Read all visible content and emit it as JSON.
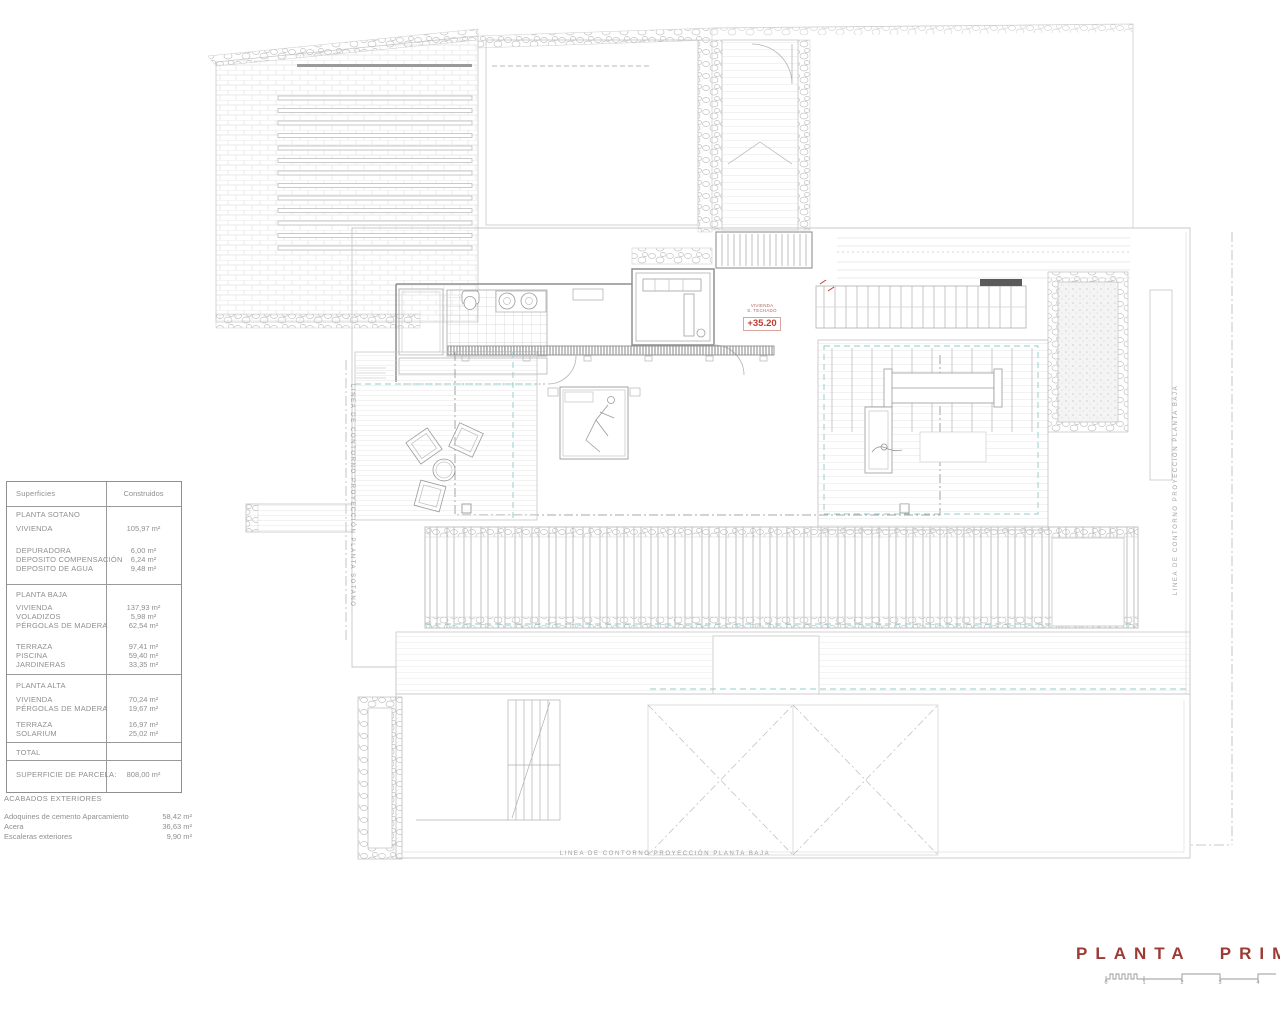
{
  "drawing": {
    "level_marker": {
      "line1": "VIVIENDA",
      "line2": "S. TECHADO",
      "value": "+35.20"
    },
    "contour_labels": {
      "left": "LINEA DE CONTORNO PROYECCIÓN PLANTA SOTANO",
      "right": "LINEA DE CONTORNO PROYECCIÓN PLANTA BAJA",
      "bottom": "LINEA DE CONTORNO PROYECCIÓN PLANTA BAJA"
    }
  },
  "surfaces_table": {
    "header": {
      "label": "Superficies",
      "value": "Construidos"
    },
    "rows": [
      {
        "label": "PLANTA SOTANO",
        "value": ""
      },
      {
        "label": "VIVIENDA",
        "value": "105,97 m²"
      },
      {
        "label": "DEPURADORA",
        "value": "6,00 m²"
      },
      {
        "label": "DEPOSITO COMPENSACIÓN",
        "value": "6,24 m²"
      },
      {
        "label": "DEPOSITO DE AGUA",
        "value": "9,48 m²"
      },
      {
        "label": "PLANTA BAJA",
        "value": ""
      },
      {
        "label": "VIVIENDA",
        "value": "137,93 m²"
      },
      {
        "label": "VOLADIZOS",
        "value": "5,98 m²"
      },
      {
        "label": "PÉRGOLAS DE MADERA",
        "value": "62,54 m²"
      },
      {
        "label": "TERRAZA",
        "value": "97,41 m²"
      },
      {
        "label": "PISCINA",
        "value": "59,40 m²"
      },
      {
        "label": "JARDINERAS",
        "value": "33,35 m²"
      },
      {
        "label": "PLANTA ALTA",
        "value": ""
      },
      {
        "label": "VIVIENDA",
        "value": "70,24 m²"
      },
      {
        "label": "PÉRGOLAS DE MADERA",
        "value": "19,67 m²"
      },
      {
        "label": "TERRAZA",
        "value": "16,97 m²"
      },
      {
        "label": "SOLARIUM",
        "value": "25,02 m²"
      },
      {
        "label": "TOTAL",
        "value": ""
      },
      {
        "label": "SUPERFICIE DE PARCELA:",
        "value": "808,00 m²"
      }
    ]
  },
  "exterior_finishes": {
    "title": "ACABADOS EXTERIORES",
    "rows": [
      {
        "label": "Adoquines de cemento Aparcamiento",
        "value": "58,42 m²"
      },
      {
        "label": "Acera",
        "value": "36,63 m²"
      },
      {
        "label": "Escaleras exteriores",
        "value": "9,90 m²"
      }
    ]
  },
  "title_block": {
    "title": "PLANTA PRIMERA",
    "scale_ticks": [
      "0",
      "1",
      "2",
      "3",
      "4"
    ]
  },
  "colors": {
    "accent_red": "#9c3a34",
    "level_red": "#c13b30",
    "teal": "#8fccc8"
  }
}
